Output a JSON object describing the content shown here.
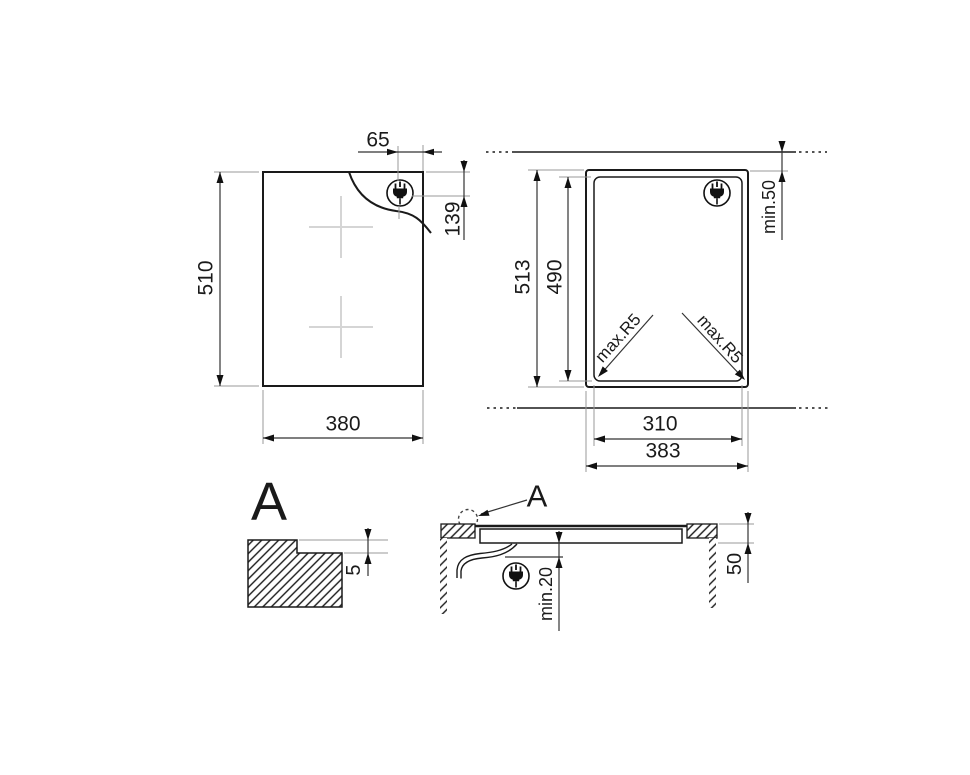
{
  "drawing": {
    "title": "cooktop-installation-diagram",
    "line_color": "#1a1a1a",
    "extension_line_color": "#9a9a9a",
    "cross_marker_color": "#d5d5d5",
    "background": "#ffffff"
  },
  "hob_top_view": {
    "plug_from_right": "65",
    "plug_from_top": "139",
    "height": "510",
    "width": "380",
    "plug_icon": "power-plug"
  },
  "cutout_view": {
    "min_rear_clearance": "min.50",
    "outer_height": "513",
    "inner_height": "490",
    "corner_radius_left": "max.R5",
    "corner_radius_right": "max.R5",
    "inner_width": "310",
    "outer_width": "383",
    "plug_icon": "power-plug"
  },
  "edge_detail_view": {
    "ref": "A",
    "step_height": "5"
  },
  "section_view": {
    "ref": "A",
    "min_under_clearance": "min.20",
    "side_distance": "50",
    "plug_icon": "power-plug"
  }
}
